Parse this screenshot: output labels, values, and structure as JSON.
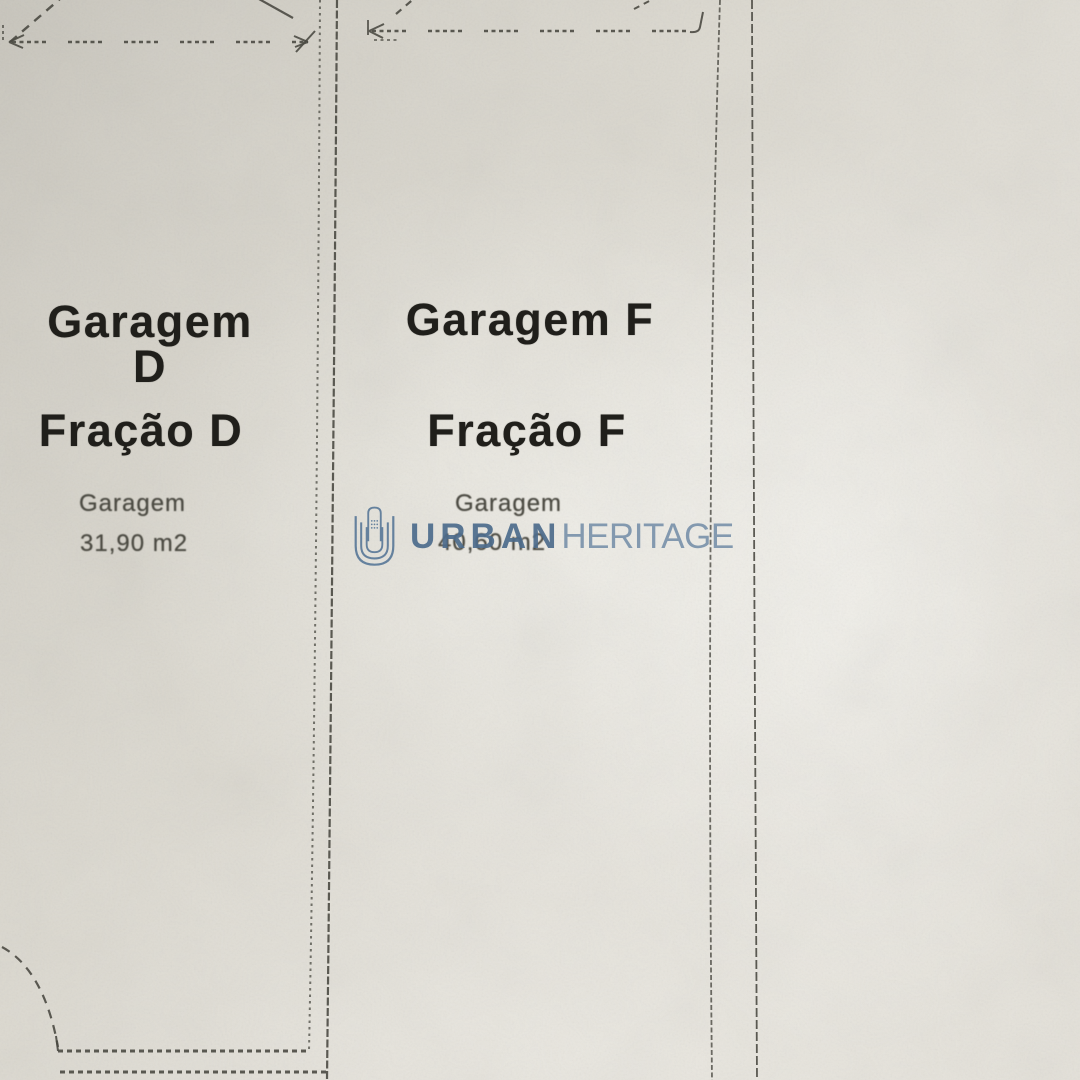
{
  "document": {
    "kind": "garage floor plan (photographed print)",
    "language": "pt"
  },
  "units": [
    {
      "name": "Garagem D",
      "fraction": "Fração D",
      "label": "Garagem",
      "area": "31,90 m2"
    },
    {
      "name": "Garagem F",
      "fraction": "Fração F",
      "label": "Garagem",
      "area": "40,60 m2"
    }
  ],
  "watermark": {
    "bold": "URBAN",
    "light": "HERITAGE",
    "logo": "urban-heritage-building-logo",
    "color_bold": "#4d6c8c",
    "color_light": "#7b93ab",
    "logo_color": "#5b7a99"
  },
  "colors": {
    "paper": "#dcd9d0",
    "ink": "#201f1b",
    "plan_line": "#46453d",
    "small_text": "#4b4a42"
  }
}
